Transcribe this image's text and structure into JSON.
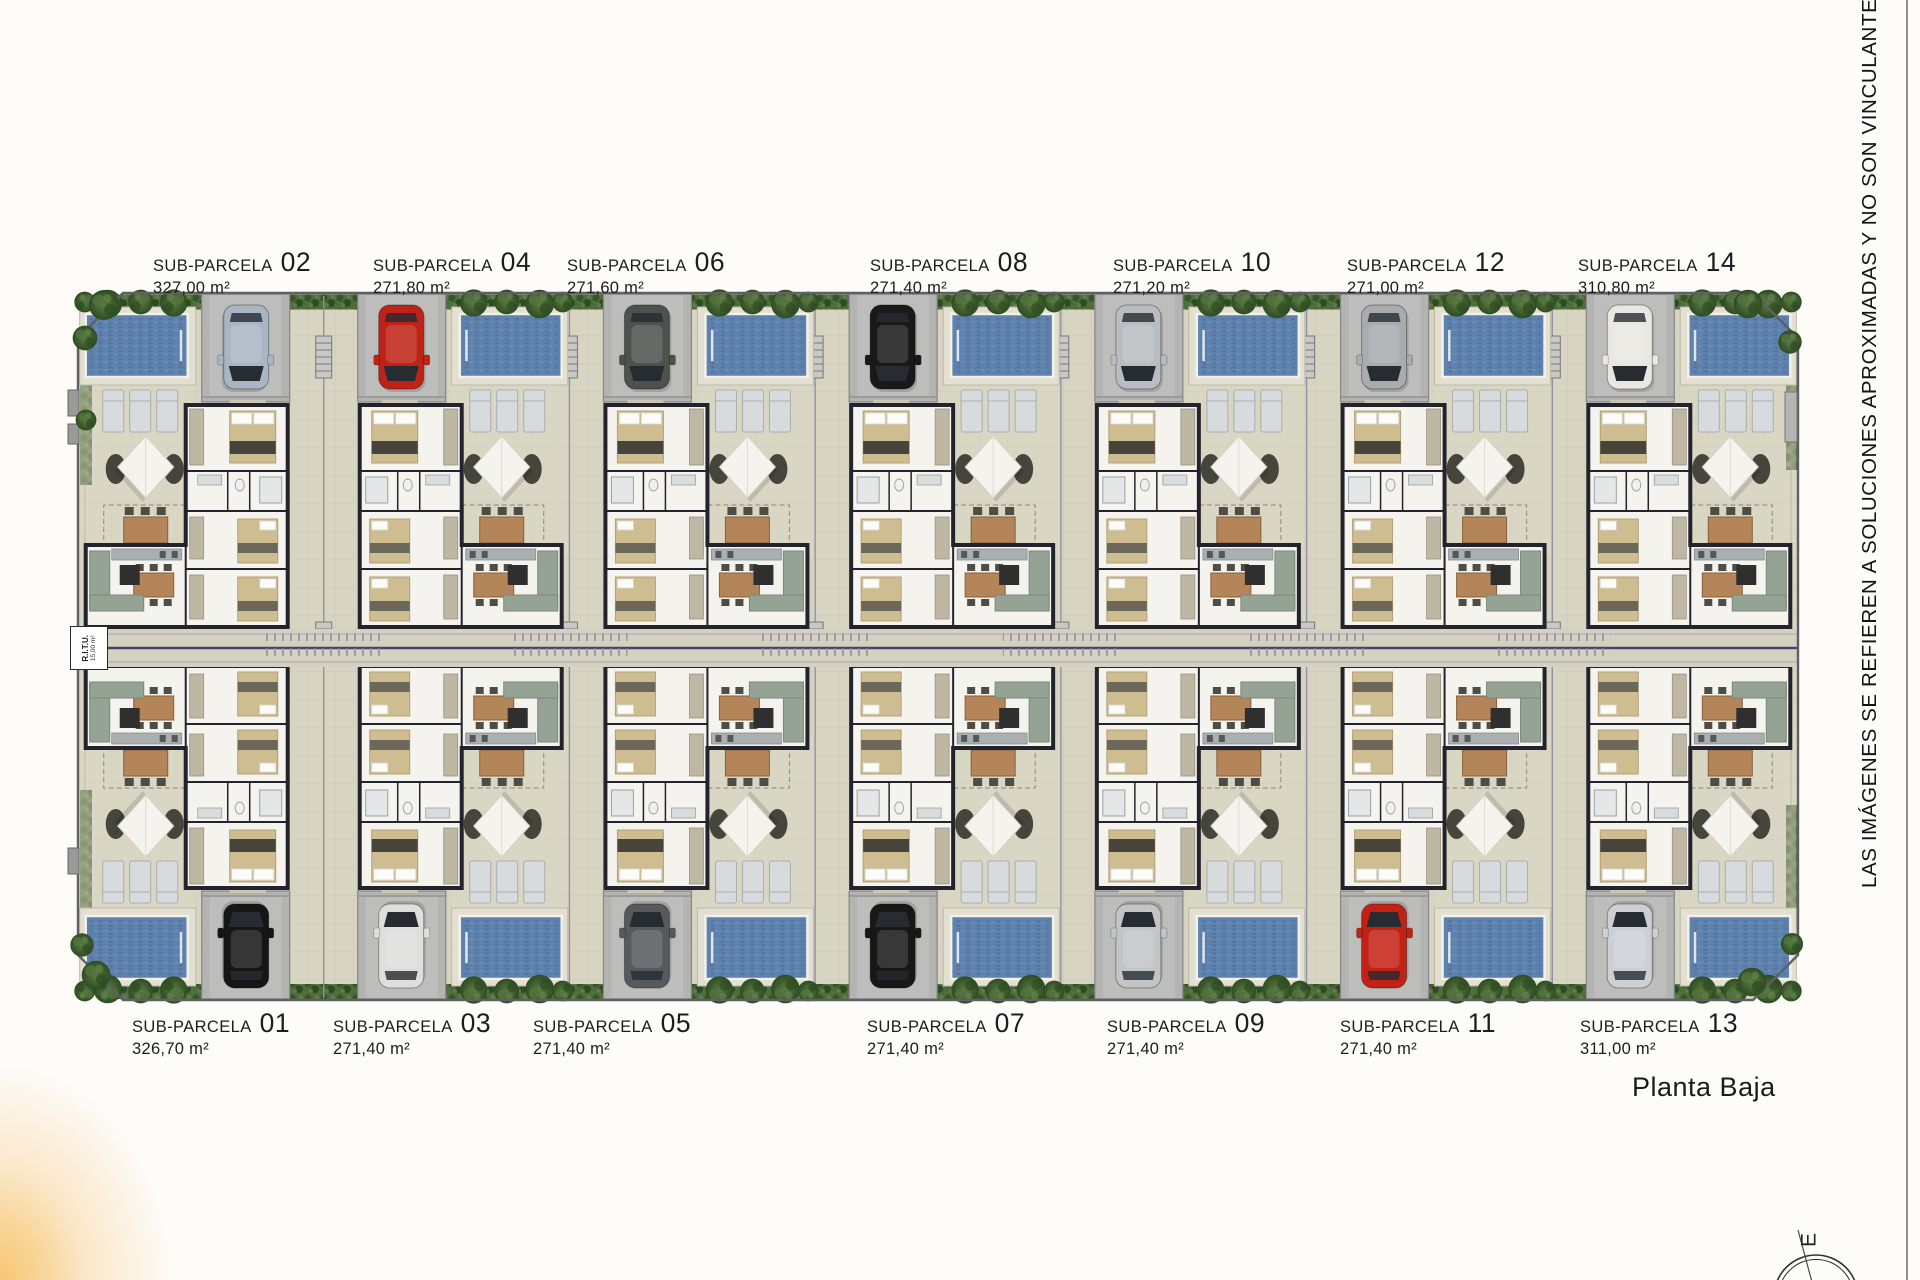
{
  "label_prefix": "SUB-PARCELA",
  "plan_title": "Planta Baja",
  "side_note": "LAS IMÁGENES SE REFIEREN A SOLUCIONES APROXIMADAS Y NO SON VINCULANTES AL PROYECT",
  "ritu": {
    "line1": "R.I.T.U.",
    "line2": "15,00 m²"
  },
  "compass": {
    "label": "E"
  },
  "parcels": {
    "top": [
      {
        "number": "02",
        "area": "327,00 m²",
        "car": "#a9b5c3"
      },
      {
        "number": "04",
        "area": "271,80 m²",
        "car": "#bf2217"
      },
      {
        "number": "06",
        "area": "271,60 m²",
        "car": "#4d524d"
      },
      {
        "number": "08",
        "area": "271,40 m²",
        "car": "#191919"
      },
      {
        "number": "10",
        "area": "271,20 m²",
        "car": "#b9bdc1"
      },
      {
        "number": "12",
        "area": "271,00 m²",
        "car": "#a9abae"
      },
      {
        "number": "14",
        "area": "310,80 m²",
        "car": "#e9e7e1"
      }
    ],
    "bottom": [
      {
        "number": "01",
        "area": "326,70 m²",
        "car": "#161616"
      },
      {
        "number": "03",
        "area": "271,40 m²",
        "car": "#dededc"
      },
      {
        "number": "05",
        "area": "271,40 m²",
        "car": "#565a5e"
      },
      {
        "number": "07",
        "area": "271,40 m²",
        "car": "#181818"
      },
      {
        "number": "09",
        "area": "271,40 m²",
        "car": "#c2c4c6"
      },
      {
        "number": "11",
        "area": "271,40 m²",
        "car": "#c42115"
      },
      {
        "number": "13",
        "area": "311,00 m²",
        "car": "#ccd0d4"
      }
    ]
  },
  "colors": {
    "ground": "#d8d4c2",
    "ground_line": "#c9c5b3",
    "road": "#b3b3b1",
    "pool": "#5e82ad",
    "pool_dark": "#54769f",
    "hedge": "#4e6c3c",
    "tree_dark": "#2e4c22",
    "house_wall": "#23232d",
    "house_floor": "#f4f3ee",
    "corridor_line": "#44446a",
    "divider": "#9191a6",
    "accent_glow": "#f3b046"
  }
}
